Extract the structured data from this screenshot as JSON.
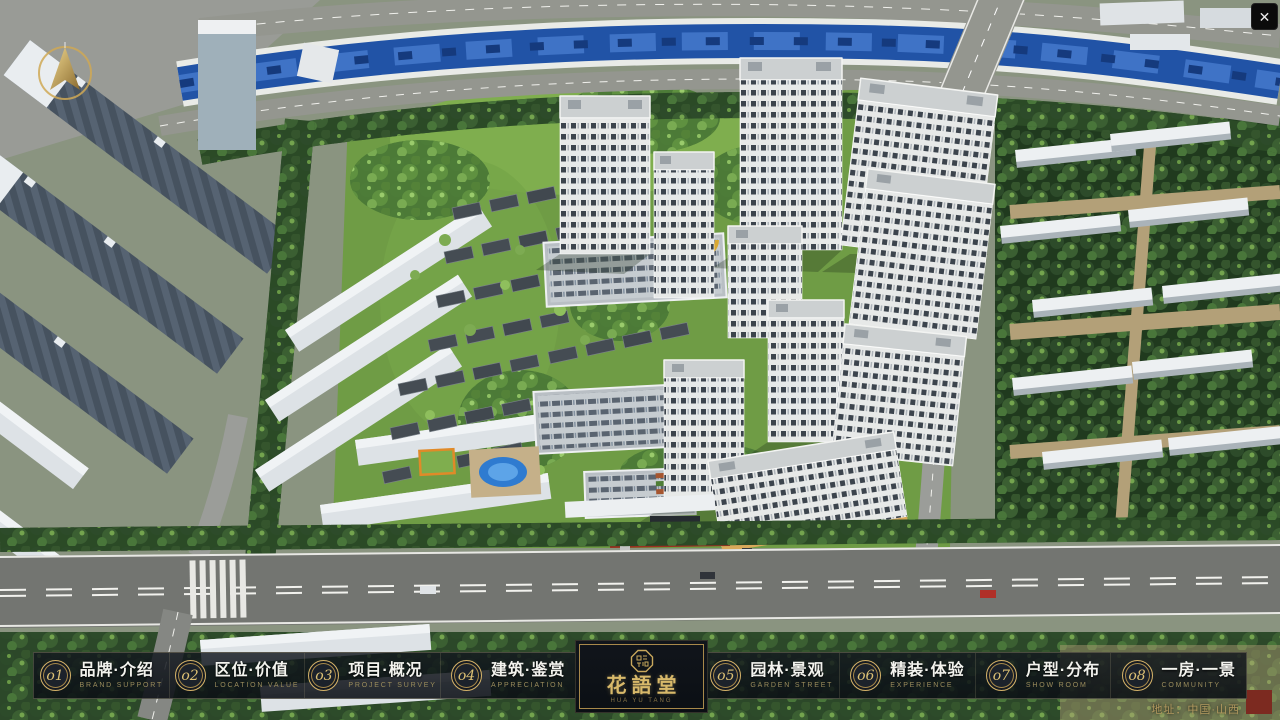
{
  "window": {
    "close_label": "✕"
  },
  "nav": {
    "items": [
      {
        "num": "o1",
        "zh": "品牌·介绍",
        "en": "BRAND SUPPORT"
      },
      {
        "num": "o2",
        "zh": "区位·价值",
        "en": "LOCATION VALUE"
      },
      {
        "num": "o3",
        "zh": "项目·概况",
        "en": "PROJECT SURVEY"
      },
      {
        "num": "o4",
        "zh": "建筑·鉴赏",
        "en": "APPRECIATION"
      },
      {
        "num": "o5",
        "zh": "园林·景观",
        "en": "GARDEN STREET"
      },
      {
        "num": "o6",
        "zh": "精装·体验",
        "en": "EXPERIENCE"
      },
      {
        "num": "o7",
        "zh": "户型·分布",
        "en": "SHOW ROOM"
      },
      {
        "num": "o8",
        "zh": "一房·一景",
        "en": "COMMUNITY"
      }
    ]
  },
  "logo": {
    "title": "花語堂",
    "tagline": "HUA YU TANG"
  },
  "footer": {
    "address": "地址：中国·山西"
  },
  "colors": {
    "accent_gold": "#c9a85c",
    "river_blue": "#2456a8"
  }
}
